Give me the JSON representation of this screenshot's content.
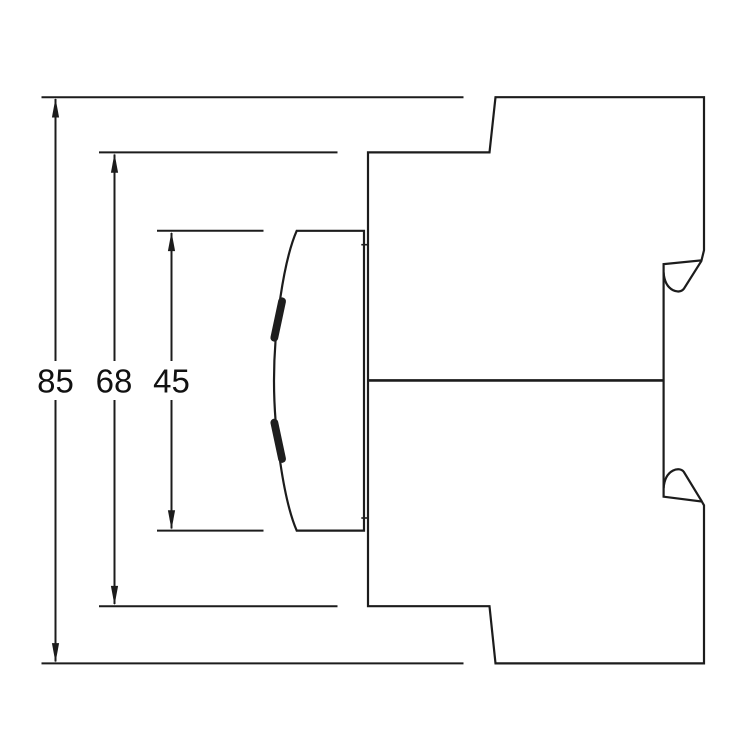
{
  "figure": {
    "type": "technical-dimension-drawing",
    "background_color": "#ffffff",
    "line_color": "#1c1c1c",
    "label_color": "#111111",
    "dimensions": [
      {
        "id": "overall-height",
        "label": "85"
      },
      {
        "id": "housing-height",
        "label": "68"
      },
      {
        "id": "front-section-height",
        "label": "45"
      }
    ]
  }
}
